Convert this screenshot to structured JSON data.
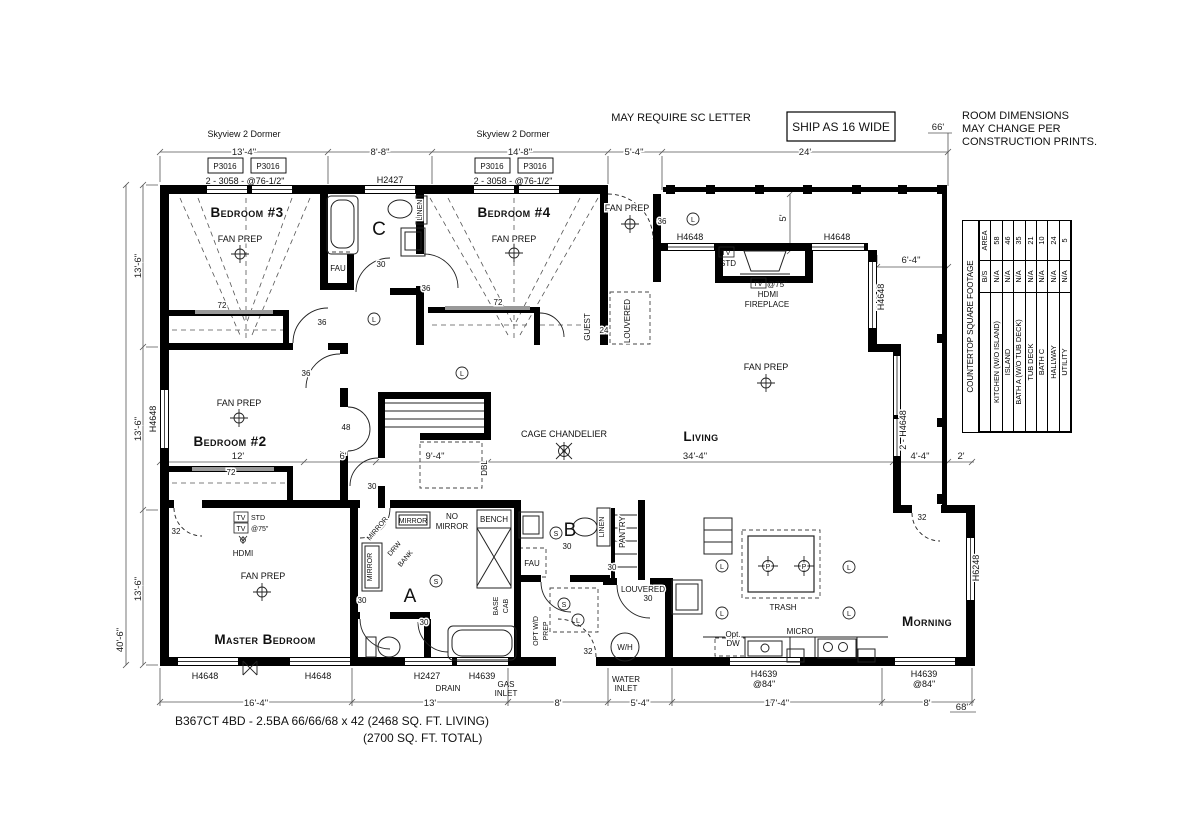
{
  "notes": {
    "may_require": "MAY REQUIRE SC LETTER",
    "ship_as": "SHIP AS 16 WIDE",
    "note1": "ROOM DIMENSIONS",
    "note2": "MAY CHANGE PER",
    "note3": "CONSTRUCTION PRINTS."
  },
  "titles": {
    "title1": "B367CT  4BD - 2.5BA  66/66/68 x 42  (2468 SQ. FT.  LIVING)",
    "title2": "(2700 SQ. FT.  TOTAL)"
  },
  "rooms": {
    "bedroom3": "Bedroom #3",
    "bedroom4": "Bedroom #4",
    "bedroom2": "Bedroom #2",
    "master": "Master Bedroom",
    "living": "Living",
    "morning": "Morning"
  },
  "dims": {
    "d66": "66'",
    "d68": "68'",
    "d13_4": "13'-4\"",
    "d8_8": "8'-8\"",
    "d14_8": "14'-8\"",
    "d5_4": "5'-4\"",
    "d24": "24'",
    "d13_6": "13'-6\"",
    "d40_6": "40'-6\"",
    "d16_4": "16'-4\"",
    "d13": "13'",
    "d8": "8'",
    "d17_4": "17'-4\"",
    "d12": "12'",
    "d6": "6'",
    "d9_4": "9'-4\"",
    "d34_4": "34'-4\"",
    "d6_4": "6'-4\"",
    "d4_4": "4'-4\"",
    "d2": "2'",
    "d5": "5'"
  },
  "labels": {
    "skyview": "Skyview 2 Dormer",
    "p3016": "P3016",
    "w3058": "2 - 3058 - @76-1/2\"",
    "h2427": "H2427",
    "h4648": "H4648",
    "h4648x2": "2 - H4648",
    "h6248": "H6248",
    "h4639": "H4639",
    "at84": "@84\"",
    "fan_prep": "FAN PREP",
    "cage": "CAGE CHANDELIER",
    "tv": "TV",
    "std": "STD",
    "at75": "@75\"",
    "hdmi": "HDMI",
    "fireplace": "FIREPLACE",
    "guest": "GUEST",
    "louvered": "LOUVERED",
    "linen": "LINEN",
    "pantry": "PANTRY",
    "fau": "FAU",
    "mirror": "MIRROR",
    "no": "NO",
    "drw": "DRW",
    "bank": "BANK",
    "bench": "BENCH",
    "base": "BASE",
    "cab": "CAB",
    "optwd": "OPT W/D",
    "prep": "PREP",
    "wh": "W/H",
    "water": "WATER",
    "inlet": "INLET",
    "gas": "GAS",
    "drain": "DRAIN",
    "trash": "TRASH",
    "micro": "MICRO",
    "opt": "Opt.",
    "dw": "DW",
    "dbl": "DBL",
    "a": "A",
    "b": "B",
    "c": "C",
    "s": "S",
    "l": "L",
    "p": "P"
  },
  "sizes": {
    "n24": "24",
    "n30": "30",
    "n32": "32",
    "n36": "36",
    "n48": "48",
    "n72": "72"
  },
  "table": {
    "title": "COUNTERTOP SQUARE FOOTAGE",
    "cols": [
      "B/S",
      "AREA"
    ],
    "rows": [
      [
        "KITCHEN (W/O ISLAND)",
        "N/A",
        "58"
      ],
      [
        "ISLAND",
        "N/A",
        "46"
      ],
      [
        "BATH A (W/O TUB DECK)",
        "N/A",
        "35"
      ],
      [
        "TUB DECK",
        "N/A",
        "21"
      ],
      [
        "BATH C",
        "N/A",
        "10"
      ],
      [
        "HALLWAY",
        "N/A",
        "24"
      ],
      [
        "UTILITY",
        "N/A",
        "5"
      ]
    ]
  }
}
